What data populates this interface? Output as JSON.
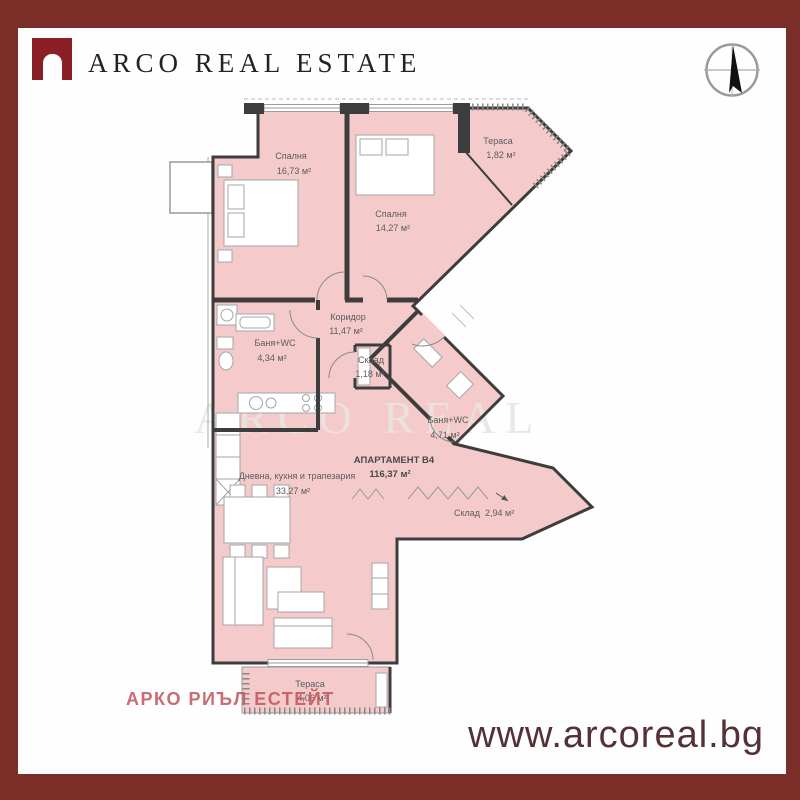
{
  "header": {
    "brand_name": "ARCO REAL ESTATE"
  },
  "floor_plan": {
    "apartment_label": "АПАРТАМЕНТ В4",
    "apartment_area": "116,37 м²",
    "watermark": "ARCO REAL",
    "rooms": [
      {
        "name": "Спалня",
        "area": "16,73 м²"
      },
      {
        "name": "Спалня",
        "area": "14,27 м²"
      },
      {
        "name": "Тераса",
        "area": "1,82 м²"
      },
      {
        "name": "Коридор",
        "area": "11,47 м²"
      },
      {
        "name": "Баня+WC",
        "area": "4,34 м²"
      },
      {
        "name": "Склад",
        "area": "1,18 м²"
      },
      {
        "name": "Баня+WC",
        "area": "4,71 м²"
      },
      {
        "name": "Склад",
        "area": "2,94 м²"
      },
      {
        "name": "Дневна, кухня и трапезария",
        "area": "33,27 м²"
      },
      {
        "name": "Тераса",
        "area": "4,06 м²"
      }
    ]
  },
  "footer": {
    "agency_name_bg": "АРКО РИЪЛ ЕСТЕЙТ",
    "website": "www.arcoreal.bg"
  },
  "colors": {
    "frame_red": "#7b2d27",
    "logo_red": "#8a2025",
    "room_pink": "#f4caca",
    "wall_dark": "#3d3d3d",
    "agency_text_red": "#c15860",
    "website_text": "#543137"
  }
}
